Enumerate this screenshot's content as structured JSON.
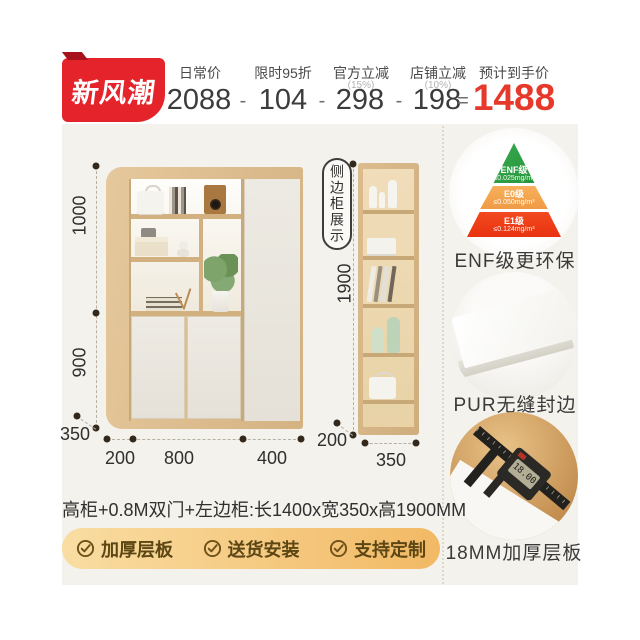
{
  "header": {
    "badge": "新风潮",
    "price_items": [
      {
        "label": "日常价",
        "sub": "",
        "value": "2088"
      },
      {
        "label": "限时95折",
        "sub": "",
        "value": "104"
      },
      {
        "label": "官方立减",
        "sub": "(15%)",
        "value": "298"
      },
      {
        "label": "店铺立减",
        "sub": "(10%)",
        "value": "198"
      },
      {
        "label": "预计到手价",
        "sub": "",
        "value": "1488"
      }
    ],
    "operators": [
      "-",
      "-",
      "-",
      "="
    ]
  },
  "diagram": {
    "side_cabinet_tag": "侧边柜展示",
    "main_dims": {
      "upper_height": "1000",
      "lower_height": "900",
      "depth": "350",
      "widths": [
        "200",
        "800",
        "400"
      ]
    },
    "side_dims": {
      "height": "1900",
      "depth": "200",
      "width": "350"
    }
  },
  "features_right": {
    "pyramid": [
      {
        "grade": "ENF级",
        "limit": "≤0.025mg/m³"
      },
      {
        "grade": "E0级",
        "limit": "≤0.050mg/m³"
      },
      {
        "grade": "E1级",
        "limit": "≤0.124mg/m³"
      }
    ],
    "captions": [
      "ENF级更环保",
      "PUR无缝封边",
      "18MM加厚层板"
    ],
    "caliper_reading": "18.00"
  },
  "footer": {
    "spec": "高柜+0.8M双门+左边柜:长1400x宽350x高1900MM",
    "features": [
      "加厚层板",
      "送货安装",
      "支持定制"
    ]
  },
  "colors": {
    "brand_red": "#e4232a",
    "price_red": "#e6392b",
    "panel_bg": "#f4f2ec",
    "wood": "#d9b989",
    "bar_gradient": [
      "#f9dda2",
      "#f2b965"
    ],
    "pyramid_colors": [
      "#2ba344",
      "#f5a94e",
      "#ef3a16"
    ]
  }
}
